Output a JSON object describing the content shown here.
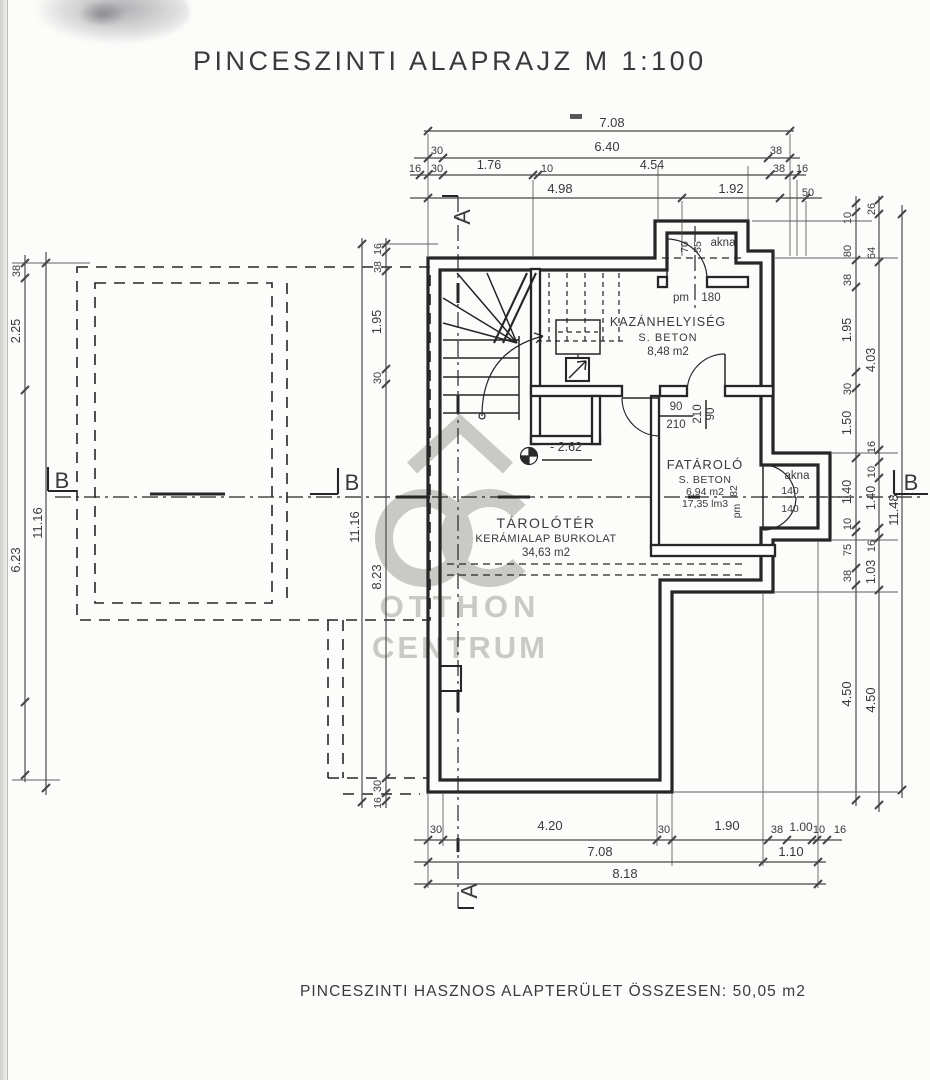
{
  "title": "PINCESZINTI ALAPRAJZ  M 1:100",
  "footer": "PINCESZINTI HASZNOS ALAPTERÜLET ÖSSZESEN: 50,05 m2",
  "colors": {
    "line": "#262626",
    "dim": "#454545",
    "ink": "#3a3a3a",
    "watermark": "#c4c4c1"
  },
  "watermark": {
    "brand_top": "OTTHON",
    "brand_bottom": "CENTRUM"
  },
  "sections": {
    "a_label": "A",
    "b_label": "B"
  },
  "rooms": {
    "kazanhelyiseg": {
      "name": "KAZÁNHELYISÉG",
      "material": "S. BETON",
      "area": "8,48 m2"
    },
    "fatarolo": {
      "name": "FATÁROLÓ",
      "material": "S. BETON",
      "area": "6,94 m2",
      "volume": "17,35 lm3"
    },
    "tarolter": {
      "name": "TÁROLÓTÉR",
      "material": "KERÁMIALAP BURKOLAT",
      "area": "34,63 m2"
    }
  },
  "labels": [
    {
      "t": "7.08",
      "x": 612,
      "y": 127,
      "r": 0,
      "s": 13
    },
    {
      "t": "30",
      "x": 437,
      "y": 154,
      "r": 0,
      "s": 11
    },
    {
      "t": "6.40",
      "x": 607,
      "y": 151,
      "r": 0,
      "s": 13
    },
    {
      "t": "38",
      "x": 776,
      "y": 154,
      "r": 0,
      "s": 11
    },
    {
      "t": "16",
      "x": 415,
      "y": 172,
      "r": 0,
      "s": 11
    },
    {
      "t": "30",
      "x": 437,
      "y": 172,
      "r": 0,
      "s": 11
    },
    {
      "t": "1.76",
      "x": 489,
      "y": 169,
      "r": 0,
      "s": 12.5
    },
    {
      "t": "10",
      "x": 547,
      "y": 172,
      "r": 0,
      "s": 11
    },
    {
      "t": "4.54",
      "x": 652,
      "y": 169,
      "r": 0,
      "s": 12.5
    },
    {
      "t": "38",
      "x": 779,
      "y": 172,
      "r": 0,
      "s": 11
    },
    {
      "t": "16",
      "x": 802,
      "y": 172,
      "r": 0,
      "s": 11
    },
    {
      "t": "4.98",
      "x": 560,
      "y": 193,
      "r": 0,
      "s": 13
    },
    {
      "t": "1.92",
      "x": 731,
      "y": 193,
      "r": 0,
      "s": 13
    },
    {
      "t": "50",
      "x": 808,
      "y": 196,
      "r": 0,
      "s": 11
    },
    {
      "t": "30",
      "x": 436,
      "y": 833,
      "r": 0,
      "s": 11
    },
    {
      "t": "4.20",
      "x": 550,
      "y": 830,
      "r": 0,
      "s": 13
    },
    {
      "t": "30",
      "x": 664,
      "y": 833,
      "r": 0,
      "s": 11
    },
    {
      "t": "1.90",
      "x": 727,
      "y": 830,
      "r": 0,
      "s": 13
    },
    {
      "t": "38",
      "x": 777,
      "y": 833,
      "r": 0,
      "s": 11
    },
    {
      "t": "1.00",
      "x": 801,
      "y": 831,
      "r": 0,
      "s": 12
    },
    {
      "t": "10",
      "x": 819,
      "y": 833,
      "r": 0,
      "s": 11
    },
    {
      "t": "16",
      "x": 840,
      "y": 833,
      "r": 0,
      "s": 11
    },
    {
      "t": "7.08",
      "x": 600,
      "y": 856,
      "r": 0,
      "s": 13
    },
    {
      "t": "1.10",
      "x": 791,
      "y": 856,
      "r": 0,
      "s": 13
    },
    {
      "t": "8.18",
      "x": 625,
      "y": 878,
      "r": 0,
      "s": 13
    },
    {
      "t": "10",
      "x": 851,
      "y": 218,
      "r": -90,
      "s": 11
    },
    {
      "t": "80",
      "x": 851,
      "y": 251,
      "r": -90,
      "s": 11
    },
    {
      "t": "38",
      "x": 851,
      "y": 280,
      "r": -90,
      "s": 11
    },
    {
      "t": "1.95",
      "x": 851,
      "y": 330,
      "r": -90,
      "s": 12.5
    },
    {
      "t": "30",
      "x": 851,
      "y": 389,
      "r": -90,
      "s": 11
    },
    {
      "t": "1.50",
      "x": 851,
      "y": 423,
      "r": -90,
      "s": 12.5
    },
    {
      "t": "1.40",
      "x": 851,
      "y": 492,
      "r": -90,
      "s": 12.5
    },
    {
      "t": "10",
      "x": 851,
      "y": 524,
      "r": -90,
      "s": 11
    },
    {
      "t": "75",
      "x": 851,
      "y": 550,
      "r": -90,
      "s": 11
    },
    {
      "t": "38",
      "x": 851,
      "y": 576,
      "r": -90,
      "s": 11
    },
    {
      "t": "4.50",
      "x": 851,
      "y": 694,
      "r": -90,
      "s": 13
    },
    {
      "t": "26",
      "x": 875,
      "y": 209,
      "r": -90,
      "s": 11
    },
    {
      "t": "64",
      "x": 875,
      "y": 253,
      "r": -90,
      "s": 11
    },
    {
      "t": "4.03",
      "x": 875,
      "y": 360,
      "r": -90,
      "s": 12.5
    },
    {
      "t": "16",
      "x": 875,
      "y": 447,
      "r": -90,
      "s": 11
    },
    {
      "t": "10",
      "x": 875,
      "y": 472,
      "r": -90,
      "s": 11
    },
    {
      "t": "1.40",
      "x": 875,
      "y": 498,
      "r": -90,
      "s": 12.5
    },
    {
      "t": "16",
      "x": 875,
      "y": 546,
      "r": -90,
      "s": 11
    },
    {
      "t": "1.03",
      "x": 875,
      "y": 572,
      "r": -90,
      "s": 12.5
    },
    {
      "t": "4.50",
      "x": 875,
      "y": 700,
      "r": -90,
      "s": 13
    },
    {
      "t": "11.48",
      "x": 898,
      "y": 510,
      "r": -90,
      "s": 13
    },
    {
      "t": "38",
      "x": 20,
      "y": 271,
      "r": -90,
      "s": 11
    },
    {
      "t": "2.25",
      "x": 20,
      "y": 331,
      "r": -90,
      "s": 12.5
    },
    {
      "t": "6.23",
      "x": 20,
      "y": 560,
      "r": -90,
      "s": 13
    },
    {
      "t": "11.16",
      "x": 42,
      "y": 523,
      "r": -90,
      "s": 13
    },
    {
      "t": "16",
      "x": 381,
      "y": 249,
      "r": -90,
      "s": 10.5
    },
    {
      "t": "38",
      "x": 381,
      "y": 267,
      "r": -90,
      "s": 10.5
    },
    {
      "t": "1.95",
      "x": 381,
      "y": 322,
      "r": -90,
      "s": 12.5
    },
    {
      "t": "30",
      "x": 381,
      "y": 378,
      "r": -90,
      "s": 11
    },
    {
      "t": "8.23",
      "x": 381,
      "y": 577,
      "r": -90,
      "s": 13
    },
    {
      "t": "30",
      "x": 381,
      "y": 786,
      "r": -90,
      "s": 11
    },
    {
      "t": "16",
      "x": 381,
      "y": 803,
      "r": -90,
      "s": 10.5
    },
    {
      "t": "11.16",
      "x": 359,
      "y": 527,
      "r": -90,
      "s": 13
    },
    {
      "t": "akna",
      "x": 723,
      "y": 246,
      "r": 0,
      "s": 11.5
    },
    {
      "t": "70",
      "x": 688,
      "y": 247,
      "r": -90,
      "s": 10.5
    },
    {
      "t": "55",
      "x": 701,
      "y": 247,
      "r": -90,
      "s": 10.5
    },
    {
      "t": "pm",
      "x": 681,
      "y": 301,
      "r": 0,
      "s": 11.5
    },
    {
      "t": "180",
      "x": 711,
      "y": 301,
      "r": 0,
      "s": 11.5
    },
    {
      "t": "90",
      "x": 676,
      "y": 410,
      "r": 0,
      "s": 11.5
    },
    {
      "t": "210",
      "x": 676,
      "y": 428,
      "r": 0,
      "s": 11.5
    },
    {
      "t": "210",
      "x": 701,
      "y": 414,
      "r": -90,
      "s": 11.5
    },
    {
      "t": "90",
      "x": 714,
      "y": 414,
      "r": -90,
      "s": 11.5
    },
    {
      "t": "- 2.62",
      "x": 566,
      "y": 451,
      "r": 0,
      "s": 12.5
    },
    {
      "t": "akna",
      "x": 797,
      "y": 479,
      "r": 0,
      "s": 11.5
    },
    {
      "t": "140",
      "x": 790,
      "y": 494,
      "r": 0,
      "s": 10.5
    },
    {
      "t": "140",
      "x": 790,
      "y": 512,
      "r": 0,
      "s": 10.5
    },
    {
      "t": "82",
      "x": 737,
      "y": 491,
      "r": -90,
      "s": 10.5
    },
    {
      "t": "pm",
      "x": 740,
      "y": 511,
      "r": -90,
      "s": 10.5
    }
  ]
}
